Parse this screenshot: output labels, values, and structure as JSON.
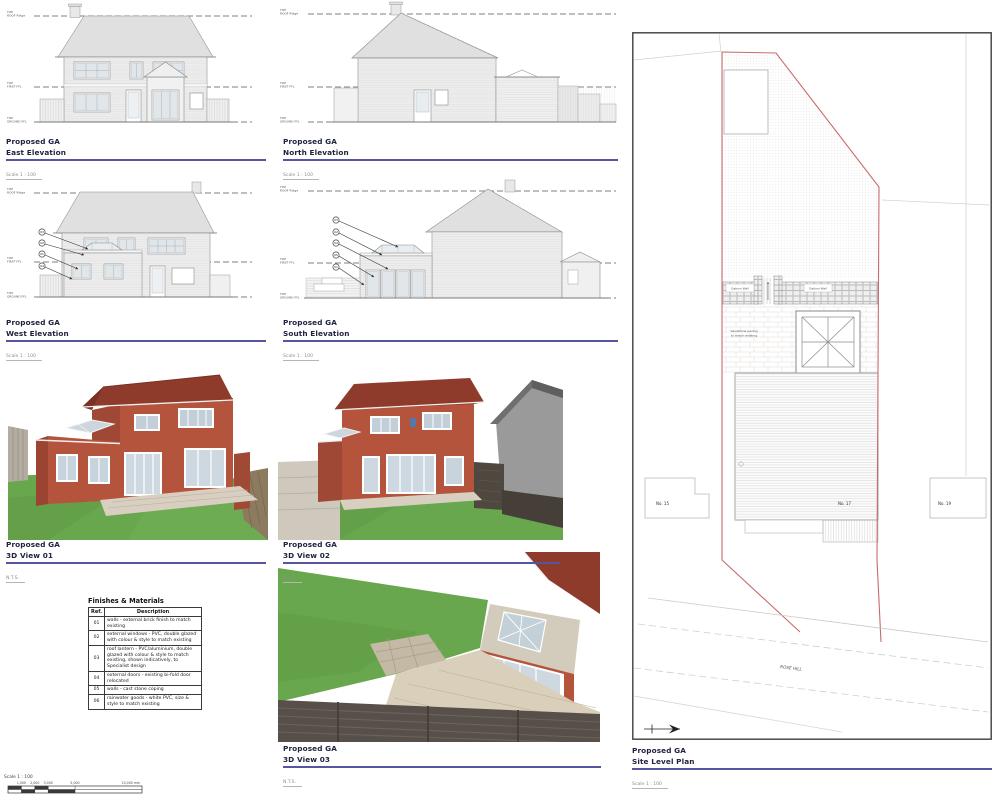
{
  "colors": {
    "title_text": "#20233f",
    "title_rule": "#56569e",
    "boundary_red": "#c96a6a",
    "roof_red": "#8e3b2c",
    "brick": "#b5543c",
    "brick_shade": "#9c4432",
    "lawn_green": "#69a74e",
    "fence_dark": "#57504a",
    "neighbour_grey": "#9a9a9a",
    "linework_grey": "#8c8c8c"
  },
  "panels": {
    "east": {
      "title": "Proposed GA",
      "subtitle": "East Elevation",
      "scale": "Scale  1 : 100"
    },
    "north": {
      "title": "Proposed GA",
      "subtitle": "North Elevation",
      "scale": "Scale  1 : 100"
    },
    "west": {
      "title": "Proposed GA",
      "subtitle": "West Elevation",
      "scale": "Scale  1 : 100"
    },
    "south": {
      "title": "Proposed GA",
      "subtitle": "South Elevation",
      "scale": "Scale  1 : 100"
    },
    "view1": {
      "title": "Proposed GA",
      "subtitle": "3D View 01",
      "scale": "N.T.S."
    },
    "view2": {
      "title": "Proposed GA",
      "subtitle": "3D View 02",
      "scale": "N.T.S."
    },
    "view3": {
      "title": "Proposed GA",
      "subtitle": "3D View 03",
      "scale": "N.T.S."
    },
    "site": {
      "title": "Proposed GA",
      "subtitle": "Site Level Plan",
      "scale": "Scale  1 : 100"
    }
  },
  "levels": {
    "top": "TOP",
    "roof": "ROOF Ridge",
    "first": "FIRST FFL",
    "ground": "GROUND FFL"
  },
  "callouts": {
    "west": [
      "03",
      "02",
      "01",
      "04"
    ],
    "south": [
      "03",
      "02",
      "04",
      "05",
      "01"
    ]
  },
  "materials": {
    "title": "Finishes & Materials",
    "col_ref": "Ref.",
    "col_desc": "Description",
    "rows": [
      {
        "ref": "01",
        "desc": "walls - external brick finish to match existing"
      },
      {
        "ref": "02",
        "desc": "external windows - PVC, double glazed with colour & style to match existing"
      },
      {
        "ref": "03",
        "desc": "roof lantern - PVC/aluminium, double glazed with colour & style to match existing, shown indicatively, to Specialist design"
      },
      {
        "ref": "04",
        "desc": "external doors - existing bi-fold door relocated"
      },
      {
        "ref": "05",
        "desc": "walls - cast stone coping"
      },
      {
        "ref": "06",
        "desc": "rainwater goods - white PVC, size & style to match existing"
      }
    ]
  },
  "site": {
    "gabion_left": "Gabion Wall",
    "gabion_right": "Gabion Wall",
    "paving_1": "Sandstone paving",
    "paving_2": "to match existing",
    "no15": "No. 15",
    "no17": "No. 17",
    "no19": "No. 19",
    "road": "ROSE HILL"
  },
  "scalebar": {
    "label": "Scale 1 : 100",
    "t1": "1,000",
    "t2": "2,000",
    "t3": "3,000",
    "t4": "5,000",
    "t5": "10,000 mm"
  }
}
